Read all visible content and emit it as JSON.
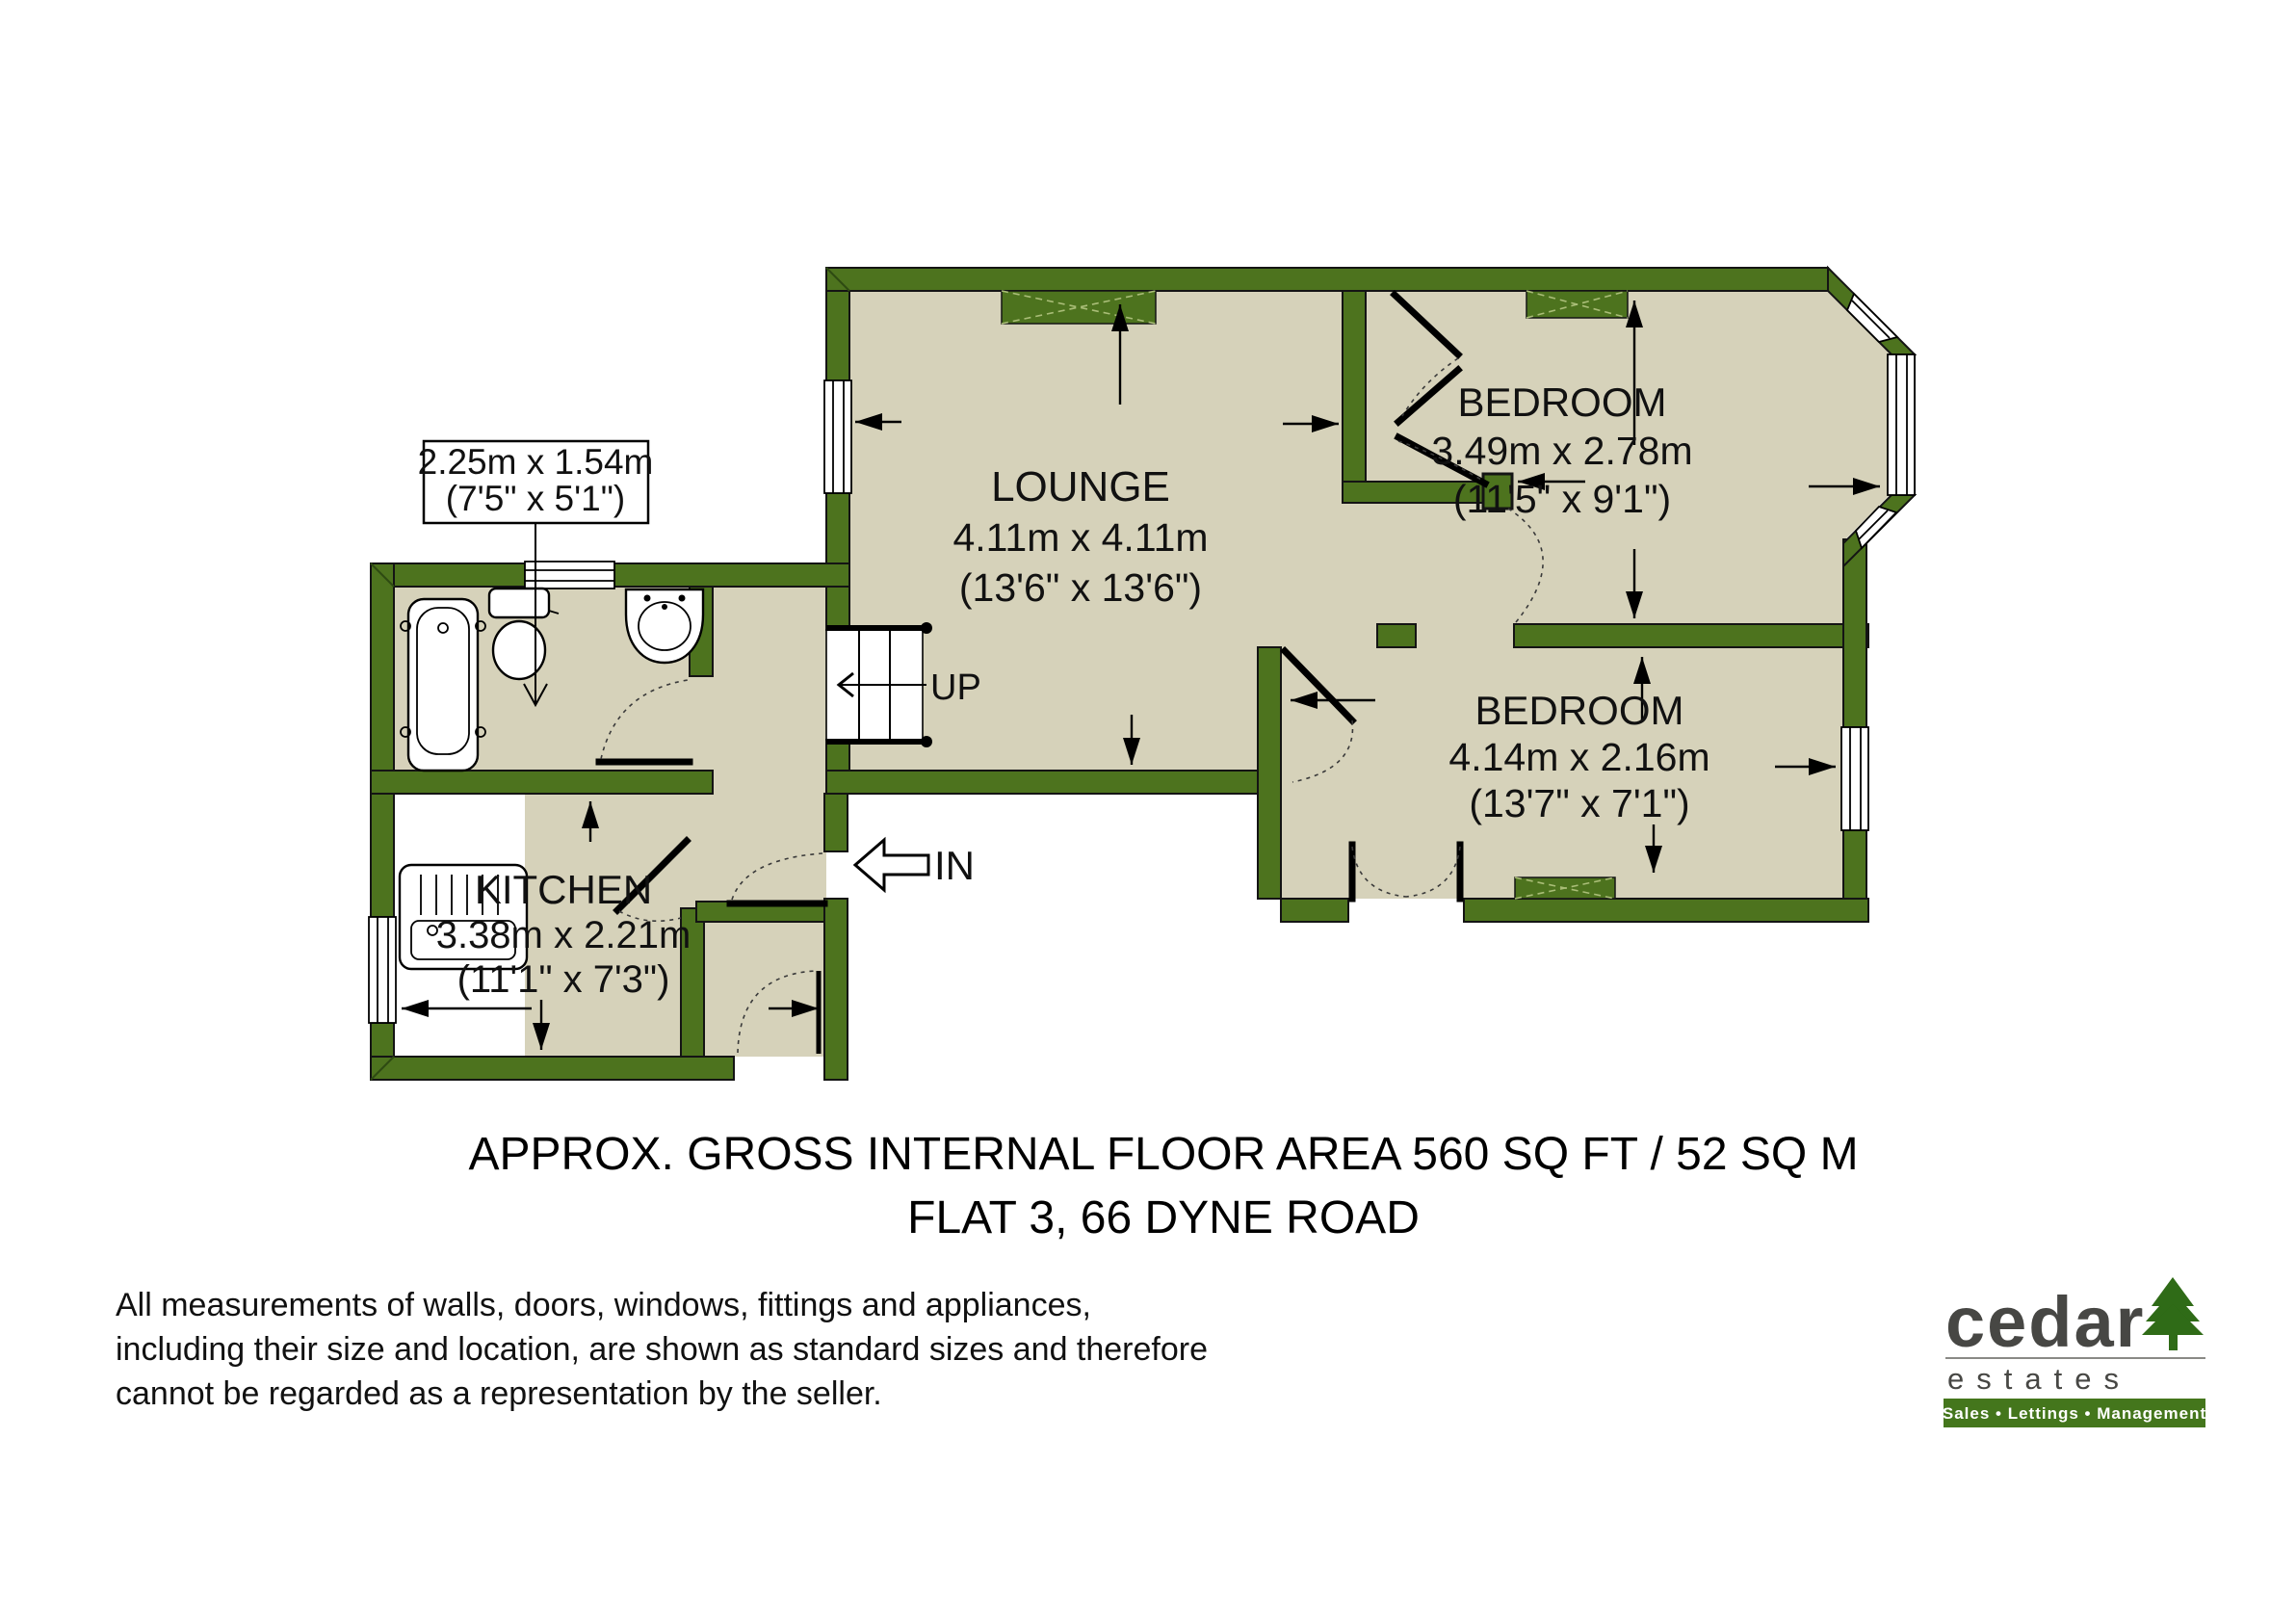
{
  "palette": {
    "wall_green": "#4d731e",
    "floor_beige": "#d6d2ba",
    "logo_green": "#44761c",
    "logo_text_gray": "#474744"
  },
  "plan": {
    "rooms": {
      "lounge": {
        "name": "LOUNGE",
        "dim_metric": "4.11m x 4.11m",
        "dim_imperial": "(13'6\" x 13'6\")"
      },
      "bedroom1": {
        "name": "BEDROOM",
        "dim_metric": "3.49m x 2.78m",
        "dim_imperial": "(11'5\" x 9'1\")"
      },
      "bedroom2": {
        "name": "BEDROOM",
        "dim_metric": "4.14m x 2.16m",
        "dim_imperial": "(13'7\" x 7'1\")"
      },
      "kitchen": {
        "name": "KITCHEN",
        "dim_metric": "3.38m x 2.21m",
        "dim_imperial": "(11'1\" x 7'3\")"
      },
      "bathroom": {
        "dim_metric": "2.25m x 1.54m",
        "dim_imperial": "(7'5\" x 5'1\")"
      }
    },
    "stairs_label": "UP",
    "entrance_label": "IN"
  },
  "footer": {
    "title_line1": "APPROX. GROSS INTERNAL FLOOR AREA 560 SQ FT / 52 SQ M",
    "title_line2": "FLAT 3, 66 DYNE ROAD",
    "disclaimer_line1": "All measurements of walls, doors, windows, fittings and appliances,",
    "disclaimer_line2": "including their size and location, are shown as standard sizes and therefore",
    "disclaimer_line3": "cannot be regarded as a representation by the seller."
  },
  "logo": {
    "brand": "cedar",
    "brand_sub": "estates",
    "tagline": "Sales • Lettings • Management"
  }
}
